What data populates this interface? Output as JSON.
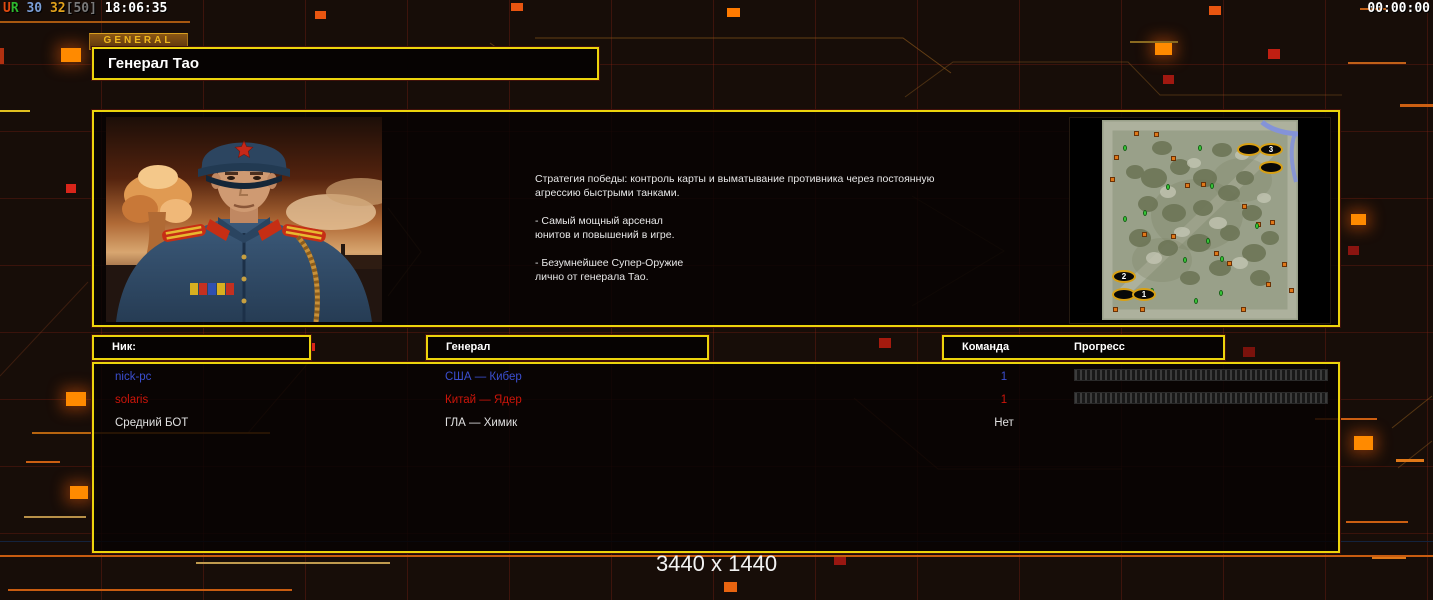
{
  "hud": {
    "perf_segments": [
      {
        "text": "U",
        "color": "#e04a10"
      },
      {
        "text": "R ",
        "color": "#2db82d"
      },
      {
        "text": "30 ",
        "color": "#7b9ed6"
      },
      {
        "text": "32",
        "color": "#e2a21c"
      },
      {
        "text": "[50] ",
        "color": "#787878"
      },
      {
        "text": "18:06:35",
        "color": "#ffffff"
      }
    ],
    "timer": "00:00:00"
  },
  "header": {
    "tab_label": "GENERAL",
    "title": "Генерал Тао"
  },
  "briefing": {
    "text": "Стратегия победы: контроль карты и выматывание противника через постоянную\n агрессию быстрыми танками.\n\n- Самый мощный арсенал\nюнитов и повышений в игре.\n\n- Безумнейшее Супер-Оружие\nлично от генерала Тао."
  },
  "minimap": {
    "start_markers": [
      {
        "x": 147,
        "y": 29,
        "label": ""
      },
      {
        "x": 169,
        "y": 29,
        "label": "3"
      },
      {
        "x": 169,
        "y": 47,
        "label": ""
      },
      {
        "x": 22,
        "y": 156,
        "label": "2"
      },
      {
        "x": 22,
        "y": 174,
        "label": ""
      },
      {
        "x": 42,
        "y": 174,
        "label": "1"
      }
    ],
    "supply_points": [
      [
        34,
        13
      ],
      [
        54,
        14
      ],
      [
        14,
        37
      ],
      [
        10,
        59
      ],
      [
        71,
        38
      ],
      [
        85,
        65
      ],
      [
        101,
        64
      ],
      [
        142,
        86
      ],
      [
        156,
        104
      ],
      [
        170,
        102
      ],
      [
        42,
        114
      ],
      [
        71,
        116
      ],
      [
        114,
        133
      ],
      [
        127,
        143
      ],
      [
        166,
        164
      ],
      [
        182,
        144
      ],
      [
        189,
        170
      ],
      [
        141,
        189
      ],
      [
        13,
        189
      ],
      [
        40,
        189
      ]
    ],
    "tech_points": [
      [
        98,
        28
      ],
      [
        23,
        28
      ],
      [
        66,
        67
      ],
      [
        43,
        93
      ],
      [
        23,
        99
      ],
      [
        106,
        121
      ],
      [
        155,
        106
      ],
      [
        120,
        139
      ],
      [
        83,
        140
      ],
      [
        119,
        173
      ],
      [
        94,
        181
      ],
      [
        50,
        171
      ],
      [
        110,
        66
      ]
    ]
  },
  "table": {
    "headers": {
      "nick": "Ник:",
      "general": "Генерал",
      "team": "Команда",
      "progress": "Прогресс"
    },
    "rows": [
      {
        "nick": "nick-pc",
        "general": "США — Кибер",
        "team": "1",
        "color": "#3b4fd0",
        "progress_bar": true
      },
      {
        "nick": "solaris",
        "general": "Китай — Ядер",
        "team": "1",
        "color": "#cc150a",
        "progress_bar": true
      },
      {
        "nick": "Средний БОТ",
        "general": "ГЛА — Химик",
        "team": "Нет",
        "color": "#e0e0e0",
        "progress_bar": false
      }
    ]
  },
  "footer": {
    "resolution": "3440 x 1440"
  },
  "colors": {
    "accent_yellow": "#ecd40c",
    "accent_orange": "#ff8a00",
    "player_blue": "#3b4fd0",
    "player_red": "#cc150a"
  }
}
